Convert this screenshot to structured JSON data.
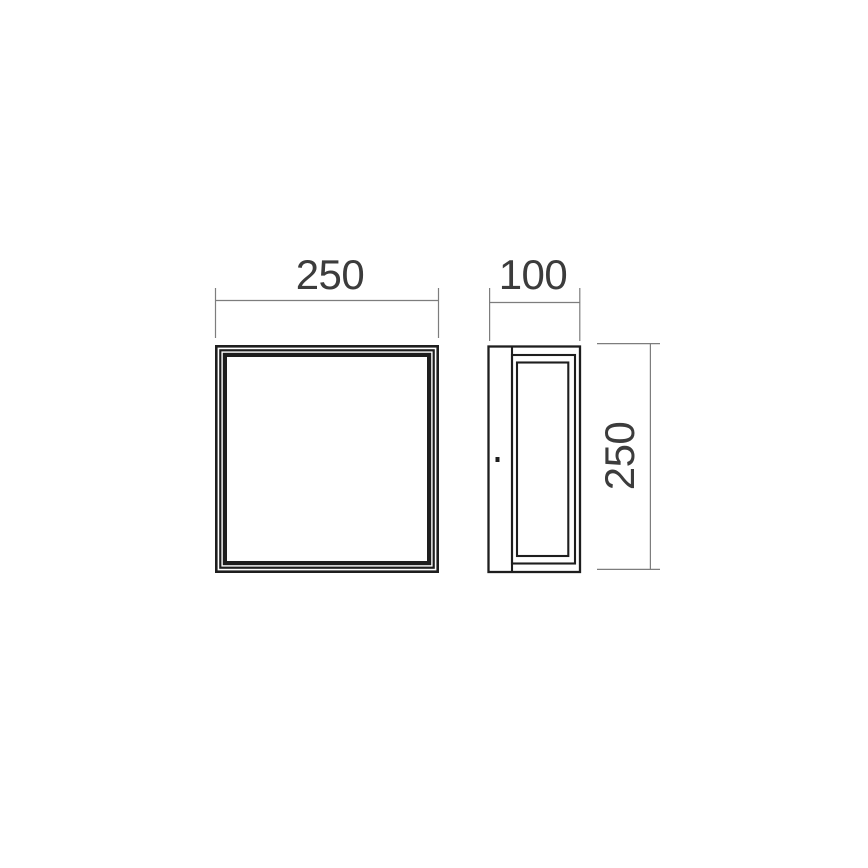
{
  "drawing": {
    "front_view": {
      "width_label": "250"
    },
    "side_view": {
      "depth_label": "100",
      "height_label": "250"
    },
    "colors": {
      "background": "#ffffff",
      "object_line": "#1e1e1e",
      "dimension_line": "#7d7d7d",
      "label_text": "#3c3c3c"
    }
  }
}
